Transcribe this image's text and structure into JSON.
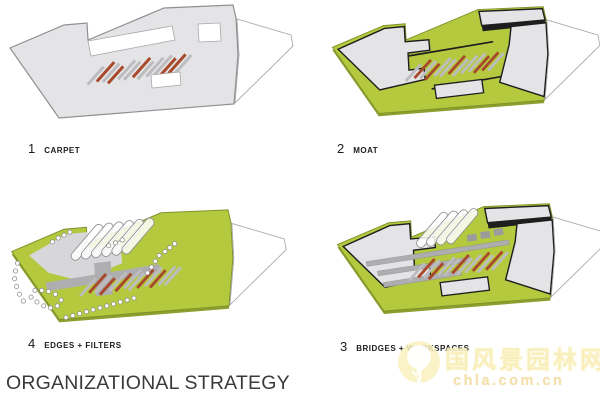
{
  "title": "ORGANIZATIONAL STRATEGY",
  "panels": [
    {
      "id": "carpet",
      "number": "1",
      "label": "CARPET"
    },
    {
      "id": "moat",
      "number": "2",
      "label": "MOAT"
    },
    {
      "id": "edges-filters",
      "number": "4",
      "label": "EDGES + FILTERS"
    },
    {
      "id": "bridges-workspaces",
      "number": "3",
      "label": "BRIDGES + WORKSPACES"
    }
  ],
  "watermark": {
    "site_name_cn": "国风景园林网",
    "site_url": "chla.com.cn"
  },
  "colors": {
    "background": "#ffffff",
    "plate_gray": "#e4e4e6",
    "plate_stroke": "#909093",
    "dark_outline": "#1e1e1e",
    "green": "#b5c93f",
    "green_shadow": "#8d9e2e",
    "green_edge": "#7f922b",
    "stripe_gray": "#bdbdbf",
    "stripe_red": "#a8492c",
    "mid_gray": "#aeaeb0",
    "plaza_gray": "#d7d7d9",
    "ghost_stroke": "#a9a9ac",
    "tree_stroke": "#8e8e90",
    "label_text": "#1c1c1c",
    "title_text": "#3a3a3a",
    "watermark_main": "#f8efb9",
    "watermark_sub": "#f3dfa9"
  }
}
